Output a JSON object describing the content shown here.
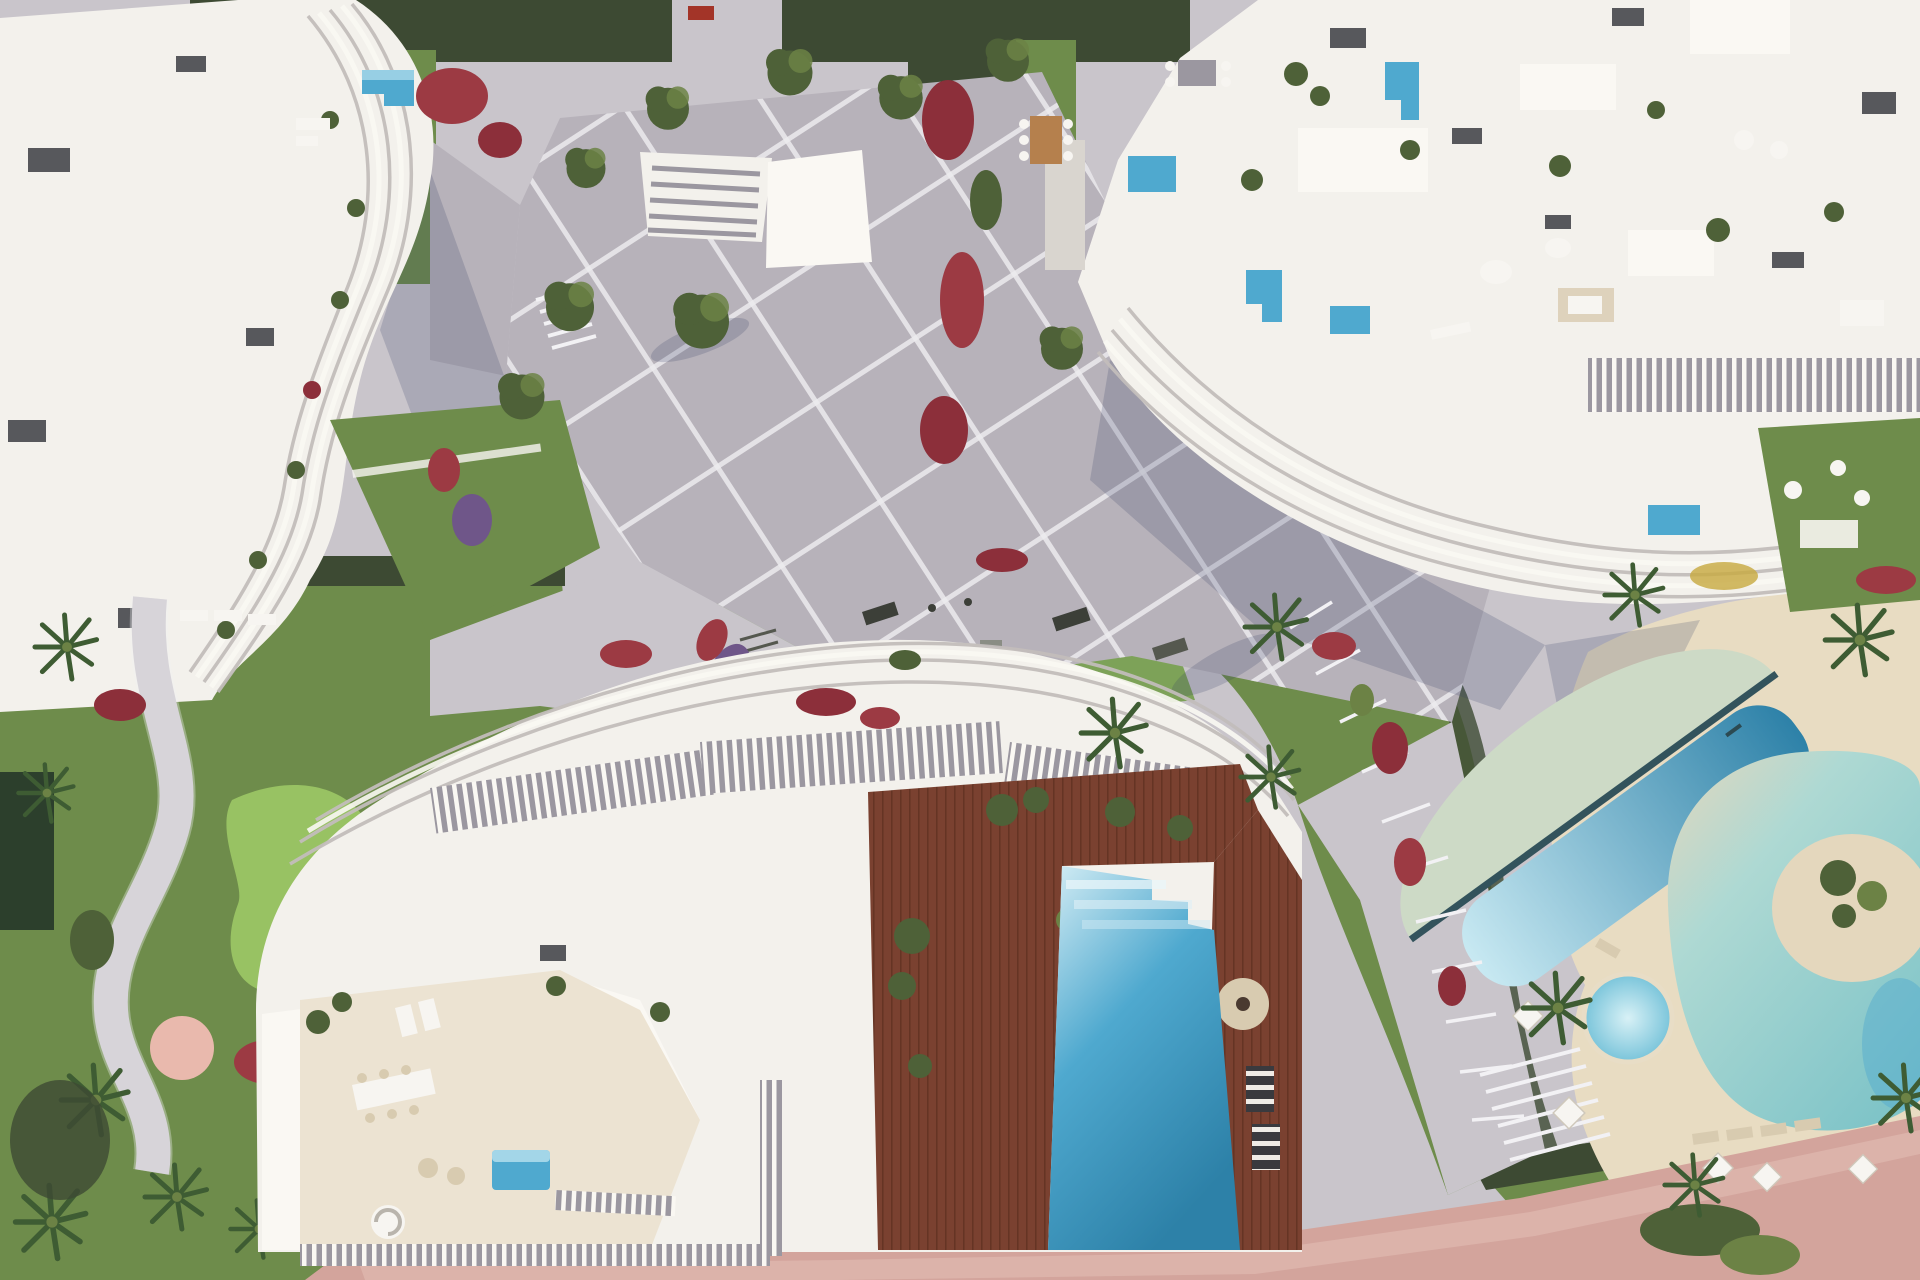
{
  "meta": {
    "description": "Aerial top-down 3D architectural render of a seaside residential resort complex",
    "view": "top-down aerial",
    "time_of_day": "sunny daylight, shadows cast to the south-west"
  },
  "palette": {
    "building_white": "#f3f1ec",
    "roof_white": "#faf8f3",
    "building_shade": "#d9d5cf",
    "rib_gray": "#c2bdba",
    "roof_box": "#57585c",
    "mid_gray": "#9b97a0",
    "plaza_gray": "#b7b2ba",
    "plaza_line": "#f2f1f4",
    "path_light": "#c9c5cb",
    "terrace_beige": "#ece3d2",
    "deck_tan": "#e8dcc2",
    "grass": "#6e8c4b",
    "grass_light": "#7da258",
    "putting_green": "#98c263",
    "hedge": "#3d4a33",
    "tree": "#4e6138",
    "tree_light": "#6c8245",
    "palm": "#3e5c33",
    "flowers_red": "#9c3a43",
    "flowers_crimson": "#8c2f3a",
    "flowers_purple": "#6f5689",
    "pool_blue": "#4fa9cf",
    "pool_light": "#c8e9f2",
    "pool_deep": "#2d81a8",
    "pool_step_light": "#d6eef5",
    "shallow_green": "#cddac6",
    "lagoon_aqua": "#aed9d3",
    "lagoon_deep": "#7fc4c8",
    "lane_dark": "#33535c",
    "jacuzzi_outer": "#79c4da",
    "jacuzzi_inner": "#d8f1f6",
    "sand": "#e4d7bd",
    "wood_deck": "#7a4130",
    "wood_line": "#653424",
    "wood_table": "#b5804d",
    "road_pink": "#d3a49c",
    "road_pink_light": "#dfb9b0",
    "shadow": "#333a63",
    "furn_white": "#f7f5f1",
    "furn_tan": "#d8cbb0",
    "rug_teal": "#3cb8ad",
    "pond_dark": "#2c3f2c",
    "pink_circle": "#e9b9ad"
  },
  "scene": {
    "buildings": [
      {
        "id": "building-top-left",
        "style": "white apartment block with wavy ribbed balconies",
        "features": [
          "rooftop lawn garden",
          "small plunge pool",
          "rooftop AC boxes",
          "red flower beds"
        ]
      },
      {
        "id": "building-top-right",
        "style": "large white apartment block with curved wave balconies",
        "features": [
          "rooftop terraces",
          "L-shaped plunge pools",
          "outdoor dining sets",
          "slatted pergola colonnade",
          "private lawns"
        ]
      },
      {
        "id": "building-bottom-center",
        "style": "white villa block with wavy rooflines and pergola slats",
        "features": [
          "hardwood roof deck",
          "large stepped rooftop pool",
          "round daybed",
          "dining terrace",
          "spiral staircase",
          "slat fences"
        ]
      }
    ],
    "amenities": [
      {
        "id": "central-plaza",
        "desc": "diagonal paved plaza with white grid lines, olive trees and palms"
      },
      {
        "id": "lagoon-pool",
        "desc": "freeform lagoon pool with sandy beach island"
      },
      {
        "id": "lap-pool",
        "desc": "angled lap pool with dark lane line and sage shallow ledge"
      },
      {
        "id": "jacuzzi",
        "desc": "round whirlpool on tan deck"
      },
      {
        "id": "rooftop-pool",
        "desc": "stepped gradient pool beside wooden deck"
      },
      {
        "id": "putting-green",
        "desc": "mini golf putting green in west garden"
      },
      {
        "id": "fitness-lawn",
        "desc": "outdoor gym lawn with exercise mats"
      },
      {
        "id": "promenade",
        "desc": "pink paved promenade along the bottom edge"
      }
    ],
    "vegetation": [
      "palm trees",
      "olive trees",
      "boxwood hedges",
      "red bougainvillea patches",
      "purple flower river"
    ],
    "furniture": [
      "white parasols",
      "sun loungers",
      "outdoor sofas",
      "wooden dining tables",
      "white poufs"
    ]
  }
}
